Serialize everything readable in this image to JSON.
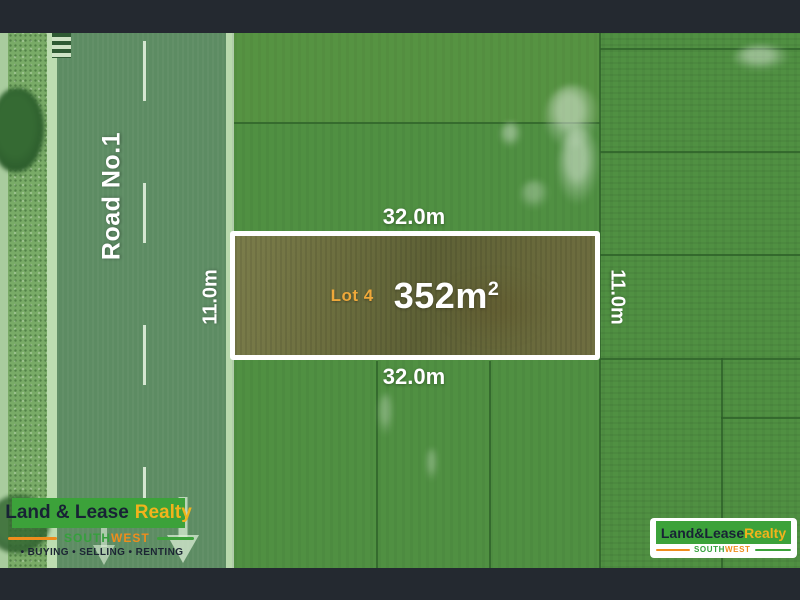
{
  "scene": {
    "road_label": "Road No.1",
    "lot": {
      "label": "Lot 4",
      "area_value": "352m",
      "area_superscript": "2"
    },
    "dimensions": {
      "top": "32.0m",
      "bottom": "32.0m",
      "left": "11.0m",
      "right": "11.0m"
    }
  },
  "branding": {
    "left": {
      "brand_primary": "Land & Lease",
      "brand_accent": "Realty",
      "region_primary": "SOUTH",
      "region_accent": "WEST",
      "tagline": "• BUYING  • SELLING  • RENTING"
    },
    "right": {
      "brand_primary": "Land&Lease",
      "brand_accent": "Realty",
      "region_primary": "SOUTH",
      "region_accent": "WEST"
    }
  },
  "colors": {
    "brand_green": "#3ca23a",
    "brand_gold": "#f2b31c",
    "brand_orange": "#ef8d1d",
    "brand_navy": "#182235",
    "lot_label_orange": "#efa83a",
    "lot_fill_olive": "#696c3d",
    "field_green": "#509042",
    "road_green": "#5d8c63",
    "letterbox_dark": "#242930",
    "boundary_white": "#ffffff"
  }
}
